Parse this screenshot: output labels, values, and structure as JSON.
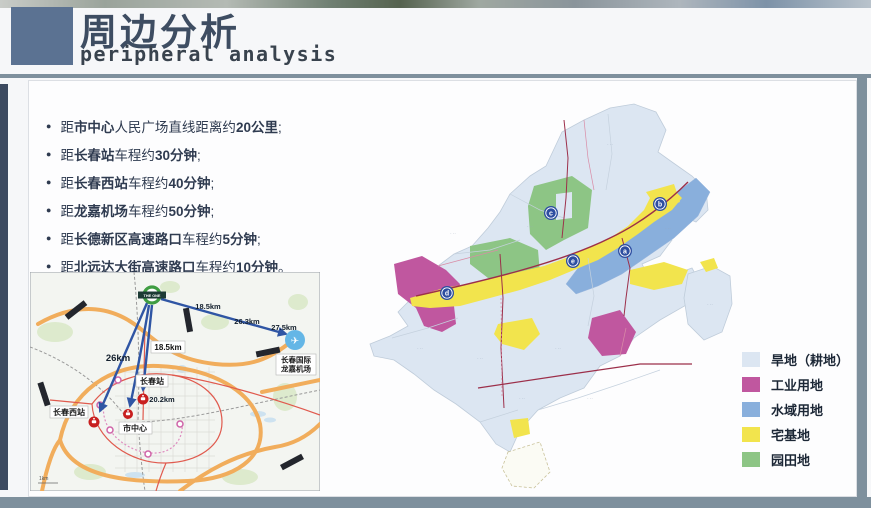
{
  "slide": {
    "title": "周边分析",
    "subtitle": "peripheral analysis"
  },
  "bullets": {
    "items": [
      [
        {
          "t": "距"
        },
        {
          "t": "市中心",
          "b": true
        },
        {
          "t": "人民广场直线距离约"
        },
        {
          "t": "20公里",
          "b": true
        },
        {
          "t": ";"
        }
      ],
      [
        {
          "t": "距"
        },
        {
          "t": "长春站",
          "b": true
        },
        {
          "t": "车程约"
        },
        {
          "t": "30分钟",
          "b": true
        },
        {
          "t": ";"
        }
      ],
      [
        {
          "t": "距"
        },
        {
          "t": "长春西站",
          "b": true
        },
        {
          "t": "车程约"
        },
        {
          "t": "40分钟",
          "b": true
        },
        {
          "t": ";"
        }
      ],
      [
        {
          "t": "距"
        },
        {
          "t": "龙嘉机场",
          "b": true
        },
        {
          "t": "车程约"
        },
        {
          "t": "50分钟",
          "b": true
        },
        {
          "t": ";"
        }
      ],
      [
        {
          "t": "距"
        },
        {
          "t": "长德新区高速路口",
          "b": true
        },
        {
          "t": "车程约"
        },
        {
          "t": "5分钟",
          "b": true
        },
        {
          "t": ";"
        }
      ],
      [
        {
          "t": "距"
        },
        {
          "t": "北远达大街高速路口",
          "b": true
        },
        {
          "t": "车程约"
        },
        {
          "t": "10分钟",
          "b": true
        },
        {
          "t": "。"
        }
      ]
    ]
  },
  "left_map": {
    "project_marker": "THE ONE",
    "labels": {
      "station": "长春站",
      "west_station": "长春西站",
      "city_center": "市中心",
      "airport_line1": "长春国际",
      "airport_line2": "龙嘉机场"
    },
    "distances": {
      "airport_a": "18.5km",
      "airport_b": "26.3km",
      "airport_c": "27.5km",
      "west": "26km",
      "center_box": "18.5km",
      "station": "20.2km"
    },
    "scale_label": "1km"
  },
  "right_map": {
    "markers": [
      "a",
      "b",
      "c",
      "d",
      "e"
    ],
    "area_label": "· ··"
  },
  "legend": {
    "items": [
      {
        "label": "旱地（耕地）",
        "color": "#dce6f2"
      },
      {
        "label": "工业用地",
        "color": "#c0579f"
      },
      {
        "label": "水域用地",
        "color": "#89afdc"
      },
      {
        "label": "宅基地",
        "color": "#f2e44d"
      },
      {
        "label": "园田地",
        "color": "#8dc585"
      }
    ]
  },
  "colors": {
    "accent": "#5b7292",
    "frame": "#7e909d",
    "leftbar": "#3c4a60",
    "title": "#3e4d62",
    "text": "#2f3b50",
    "road": "#9c2f4a",
    "arrow": "#2f55a4",
    "highway": "#f1ad5c",
    "redroad": "#e05a4e",
    "marker_blue": "#2d4da0",
    "station_red": "#c81f1f",
    "airport_blue": "#64b6e6",
    "project_green": "#3f9d42"
  }
}
